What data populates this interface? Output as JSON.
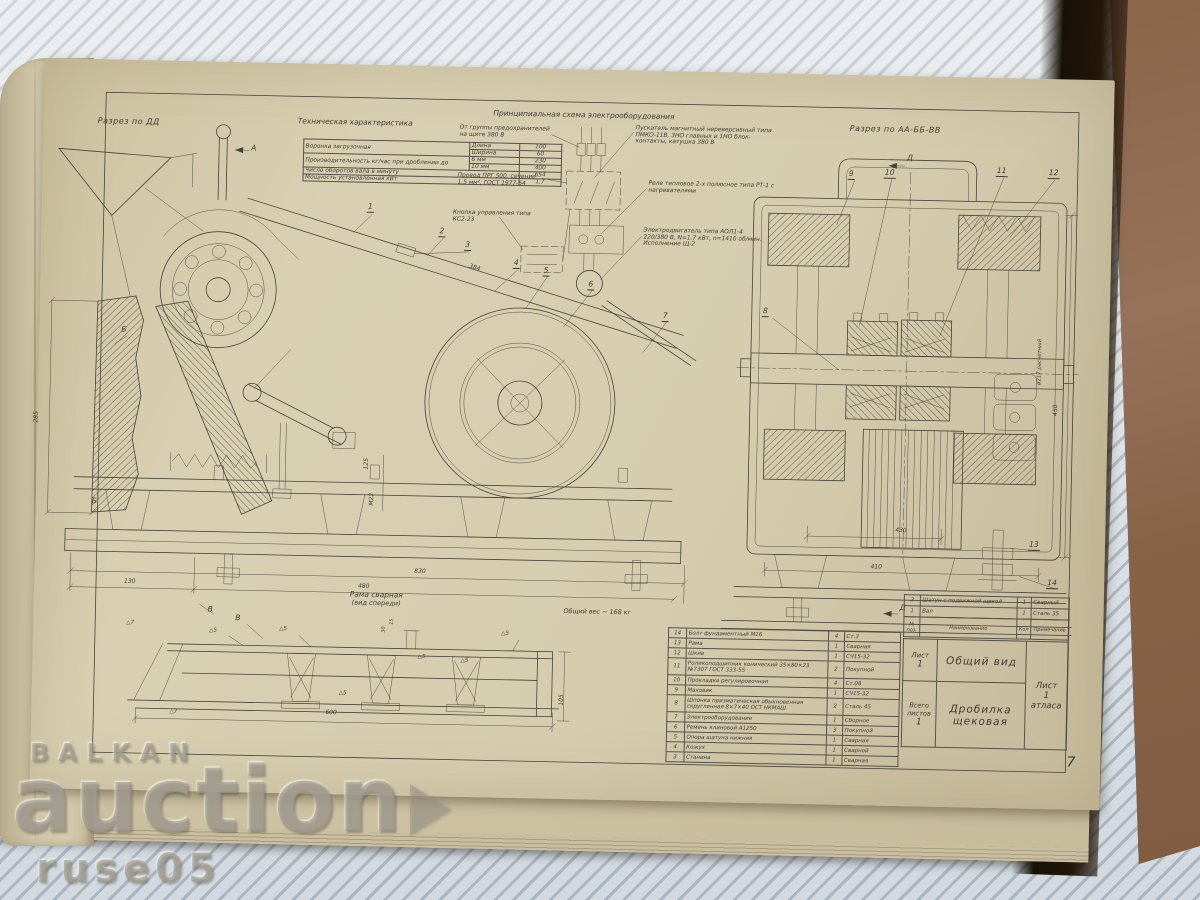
{
  "watermark": {
    "top": "BALKAN",
    "main": "auction",
    "bottom": "ruse05"
  },
  "page_number": "7",
  "sections": {
    "dd": "Разрез по ДД",
    "aabb": "Разрез по АА-ББ-ВВ",
    "frame1": "Рама сварная",
    "frame2": "(вид спереди)",
    "weight": "Общий вес ~ 168 кг"
  },
  "markers": {
    "a": "А",
    "b": "Б",
    "v": "В",
    "d": "Д"
  },
  "tech": {
    "title": "Техническая характеристика",
    "r1name": "Воронка загрузочная",
    "r1p1": "Длина",
    "r1v1": "100",
    "r1p2": "Ширина",
    "r1v2": "60",
    "r2name": "Производительность кг/час при дроблении до",
    "r2p1": "6 мм",
    "r2v1": "230",
    "r2p2": "10 мм",
    "r2v2": "400",
    "r3name": "Число оборотов вала в минуту",
    "r3v": "654",
    "r4name": "Мощность установленная кВт",
    "r4v": "1,7"
  },
  "schematic": {
    "title": "Принципиальная схема электрооборудования",
    "supply": "От группы предохранителей на щите 380 В",
    "starter": "Пускатель магнитный нереверсивный типа ПМКО-11В, 3НО главных и 1НО блок-контакты, катушка 380 В",
    "wire": "Провод ПРГ 500, сечение 1,5 мм², ГОСТ 1977-54",
    "relay": "Реле тепловое 2-х полюсное типа РТ-1 с нагревателями",
    "button": "Кнопка управления типа КС2-23",
    "motor": "Электродвигатель типа АОЛ1-4 220/380 В, N=1,7 кВт, n=1410 об/мин. Исполнение Щ-2"
  },
  "callouts": {
    "c1": "1",
    "c2": "2",
    "c3": "3",
    "c4": "4",
    "c5": "5",
    "c6": "6",
    "c7": "7",
    "c8": "8",
    "c9": "9",
    "c10": "10",
    "c11": "11",
    "c12": "12",
    "c13": "13",
    "c14": "14"
  },
  "dims": {
    "d384": "384",
    "d285": "285",
    "d130": "130",
    "d480": "480",
    "d830": "830",
    "d125": "125",
    "m22": "М22",
    "d600": "600",
    "d105": "105",
    "d30": "30",
    "d15": "15",
    "d410": "410",
    "d430": "430",
    "d450": "450",
    "d217": "ø217 расчетный",
    "w5": "△5",
    "w7": "△7"
  },
  "parts": {
    "header": {
      "num": "№ поз.",
      "name": "Наименование",
      "qty": "Кол",
      "note": "Примечание"
    },
    "rows": [
      {
        "num": "14",
        "name": "Болт фундаментный М16",
        "qty": "4",
        "note": "Ст.3"
      },
      {
        "num": "13",
        "name": "Рама",
        "qty": "1",
        "note": "Сварная"
      },
      {
        "num": "12",
        "name": "Шкив",
        "qty": "1",
        "note": "СЧ15-32"
      },
      {
        "num": "11",
        "name": "Роликоподшипник конический 35×80×23 №7307 ГОСТ 333-55",
        "qty": "2",
        "note": "Покупной"
      },
      {
        "num": "10",
        "name": "Прокладка регулировочная",
        "qty": "4",
        "note": "Ст.08"
      },
      {
        "num": "9",
        "name": "Маховик",
        "qty": "1",
        "note": "СЧ15-32"
      },
      {
        "num": "8",
        "name": "Шпонка призматическая обыкновенная скругленная 8×7×40 ОСТ НКМАШ",
        "qty": "2",
        "note": "Сталь 45"
      },
      {
        "num": "7",
        "name": "Электрооборудование",
        "qty": "1",
        "note": "Сборное"
      },
      {
        "num": "6",
        "name": "Ремень клиновой А1250",
        "qty": "3",
        "note": "Покупной"
      },
      {
        "num": "5",
        "name": "Опора шатуна нижняя",
        "qty": "1",
        "note": "Сварная"
      },
      {
        "num": "4",
        "name": "Кожух",
        "qty": "1",
        "note": "Сварной"
      },
      {
        "num": "3",
        "name": "Станина",
        "qty": "1",
        "note": "Сварная"
      },
      {
        "num": "2",
        "name": "Шатун с подвижной щекой",
        "qty": "1",
        "note": "Сварный"
      },
      {
        "num": "1",
        "name": "Вал",
        "qty": "1",
        "note": "Сталь 35"
      }
    ]
  },
  "title_block": {
    "sheet_label": "Лист",
    "sheet_value": "1",
    "view_name": "Общий вид",
    "total_label": "Всего листов",
    "total_value": "1",
    "product": "Дробилка щековая",
    "atlas_l1": "Лист",
    "atlas_l2": "1",
    "atlas_l3": "атласа"
  }
}
